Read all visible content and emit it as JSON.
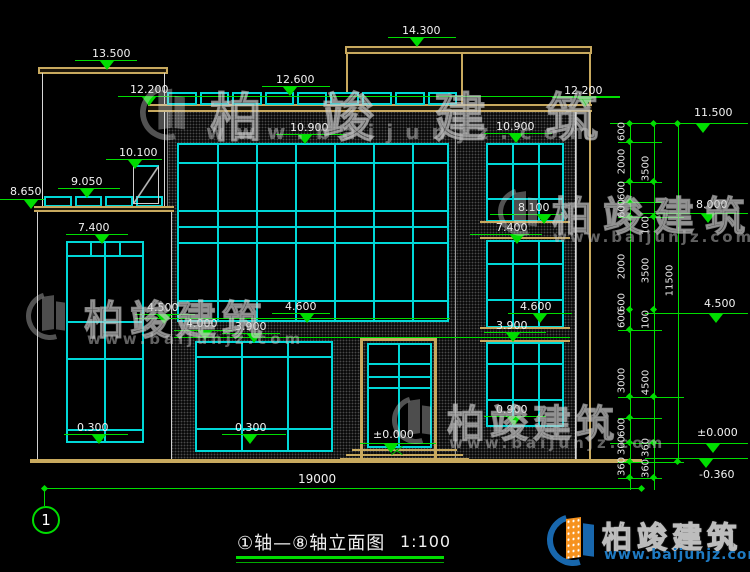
{
  "title_block": {
    "name": "①轴—⑧轴立面图",
    "scale": "1:100"
  },
  "axis_bubbles": {
    "left": "1"
  },
  "bottom_dimension": "19000",
  "levels": {
    "roof_left": "13.500",
    "terrace_left": "12.200",
    "parapet_center": "12.600",
    "roof_main": "14.300",
    "parapet_right": "12.200",
    "win_center_top": "10.900",
    "win_right_top": "10.900",
    "box_left": "10.100",
    "rail_left": "9.050",
    "slab_left": "8.650",
    "win_left_top": "7.400",
    "right_8100": "8.100",
    "right_7400": "7.400",
    "chain_11500": "11.500",
    "chain_8000": "8.000",
    "chain_4500": "4.500",
    "center_4500": "4.500",
    "center_4000": "4.000",
    "center_4600": "4.600",
    "center_3900": "3.900",
    "right_4600": "4.600",
    "right_3900": "3.900",
    "sill_left": "0.300",
    "sill_center": "0.300",
    "right_0900": "0.900",
    "door_zero": "±0.000",
    "chain_zero": "±0.000",
    "chain_neg360": "-0.360"
  },
  "dims": {
    "chain1": [
      "600",
      "2000",
      "600",
      "600",
      "2000",
      "600",
      "600",
      "3000",
      "600",
      "300",
      "360"
    ],
    "chain2": [
      "3500",
      "100",
      "3500",
      "100",
      "4500",
      "360",
      "360"
    ],
    "chain3": [
      "11500"
    ]
  },
  "watermark": {
    "brand": "柏竣建筑",
    "url": "www.baijunjz.com"
  },
  "logo": {
    "brand": "柏竣建筑",
    "url": "www.baijunjz.com"
  },
  "colors": {
    "line_green": "#00dd00",
    "frame_cyan": "#00d8d8",
    "slab_tan": "#c8a95e",
    "brand_blue": "#1b74c0",
    "brand_orange": "#f6921e"
  }
}
